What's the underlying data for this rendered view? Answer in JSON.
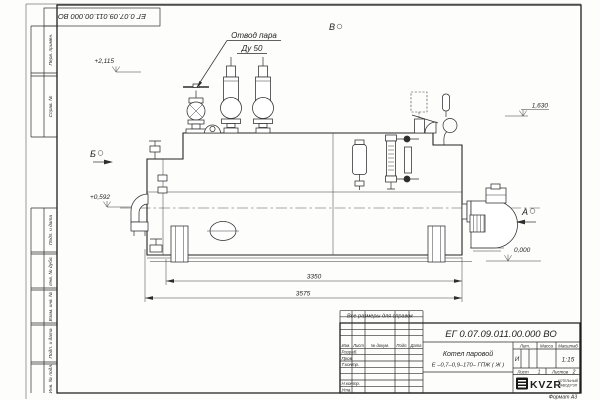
{
  "frame": {
    "top_stamp": "ЕГ 0.07.09.011.00.000  ВО",
    "margin": {
      "perv": "Перв. примен.",
      "sprav": "Справ. №",
      "podp1": "Подп. и дата",
      "inv_dubl": "Инв. № дубл.",
      "vzam": "Взам. инв. №",
      "podp2": "Подп. и дата",
      "inv_podl": "Инв. № подл."
    },
    "format_note": "Формат А3"
  },
  "annotations": {
    "steam1": "Отвод пара",
    "steam2": "Ду 50",
    "view_v": "В",
    "view_b": "Б",
    "view_a": "А",
    "elev_top": "+2,115",
    "elev_mid": "1,630",
    "elev_burner": "+0,592",
    "elev_zero": "0,000",
    "dim_inner": "3350",
    "dim_overall": "3575",
    "ref_note": "Все размеры для справок"
  },
  "title_block": {
    "designation": "ЕГ 0.07.09.011.00.000  ВО",
    "name1": "Котел паровой",
    "name2": "Е –0,7–0,9–170– ГПЖ ( Ж )",
    "col_izm": "Изм.",
    "col_list": "Лист",
    "col_doc": "№ докум.",
    "col_podp": "Подп.",
    "col_data": "Дата",
    "row_razrab": "Разраб.",
    "row_prov": "Пров.",
    "row_tkontr": "Т.контр.",
    "row_nkontr": "Н.контр.",
    "row_utv": "Утв.",
    "lit_h": "Лит.",
    "lit_v": "И",
    "mass_h": "Масса",
    "scale_h": "Масштаб",
    "scale_v": "1:15",
    "sheet_l": "Лист",
    "sheet_v": "1",
    "sheets_l": "Листов",
    "sheets_v": "2",
    "logo": "KVZR",
    "logo_s1": "КОТЕЛЬНЫЙ",
    "logo_s2": "ЗАВОД РЭП"
  }
}
